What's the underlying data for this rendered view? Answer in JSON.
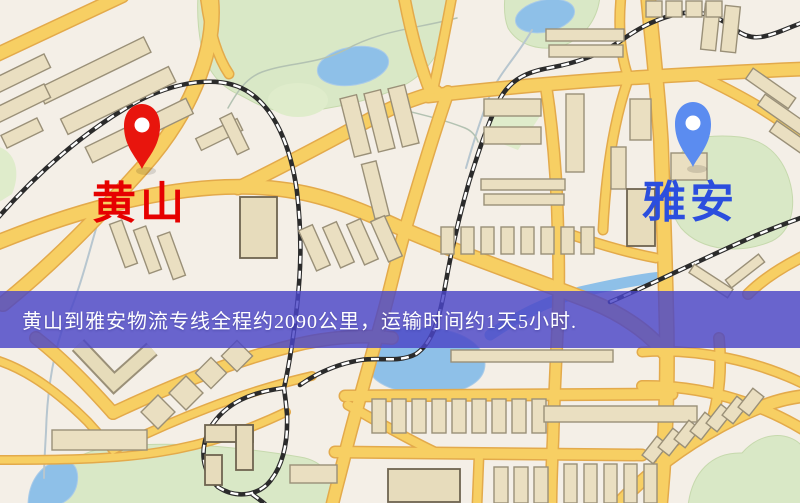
{
  "banner": {
    "text": "黄山到雅安物流专线全程约2090公里，运输时间约1天5小时.",
    "background_color": "#4a46c7",
    "text_color": "#ffffff"
  },
  "route": {
    "origin": "黄山",
    "destination": "雅安",
    "distance_text": "约2090公里",
    "duration_text": "约1天5小时"
  },
  "markers": {
    "origin": {
      "label": "黄山",
      "icon": "red-pin-icon",
      "pin_color": "#e8150d",
      "pin_hole_color": "#ffffff",
      "label_color": "#e60000"
    },
    "destination": {
      "label": "雅安",
      "icon": "blue-pin-icon",
      "pin_color": "#5b8cf0",
      "pin_hole_color": "#ffffff",
      "label_color": "#2b4ede"
    }
  },
  "map": {
    "colors": {
      "background": "#f4efe7",
      "road_fill": "#f7cf63",
      "road_casing": "#e3aa4b",
      "park": "#d9e8c6",
      "water": "#8ec0e8",
      "building": "#eadfc1",
      "railway": "#2b2b2b"
    }
  }
}
